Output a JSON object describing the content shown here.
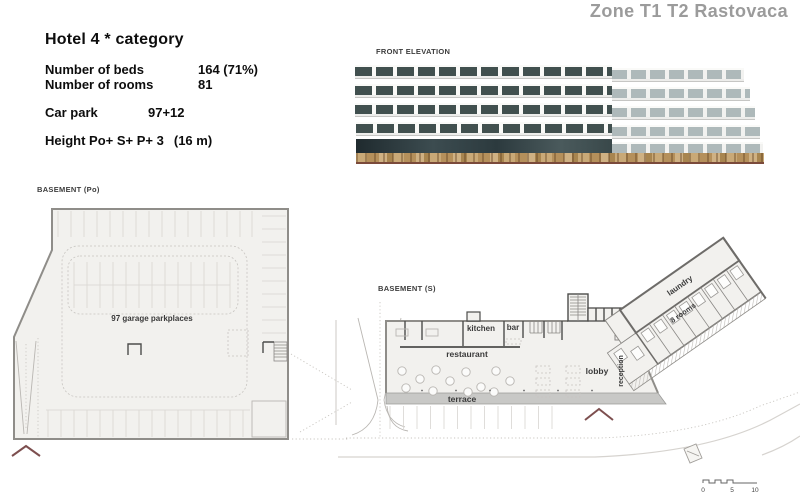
{
  "page": {
    "title": "Zone T1 T2 Rastovaca"
  },
  "info": {
    "heading": "Hotel 4 * category",
    "rows": [
      {
        "label": "Number of beds",
        "value": "164 (71%)"
      },
      {
        "label": "Number of rooms",
        "value": "81"
      },
      {
        "label": "Car park",
        "value": "97+12"
      },
      {
        "label": "Height Po+ S+ P+ 3",
        "value": "(16 m)"
      }
    ]
  },
  "sections": {
    "elevation_label": "FRONT ELEVATION",
    "basement_po_label": "BASEMENT (Po)",
    "basement_s_label": "BASEMENT (S)"
  },
  "basement_po": {
    "annotation": "97 garage parkplaces"
  },
  "basement_s": {
    "labels": {
      "kitchen": "kitchen",
      "bar": "bar",
      "restaurant": "restaurant",
      "lobby": "lobby",
      "terrace": "terrace",
      "reception": "reception",
      "laundry": "laundry",
      "eight_rooms": "8 rooms"
    }
  },
  "scale_bar": {
    "tick_0": "0",
    "tick_5": "5",
    "tick_10": "10"
  },
  "colors": {
    "title_gray": "#9b9b9b",
    "entrance_marker": "#7d4f4f",
    "window_dark": "#41504f",
    "stone_tan": "#c0a070",
    "plan_fill": "#f2f1ee",
    "terrace_gray": "#c8c8c6"
  }
}
